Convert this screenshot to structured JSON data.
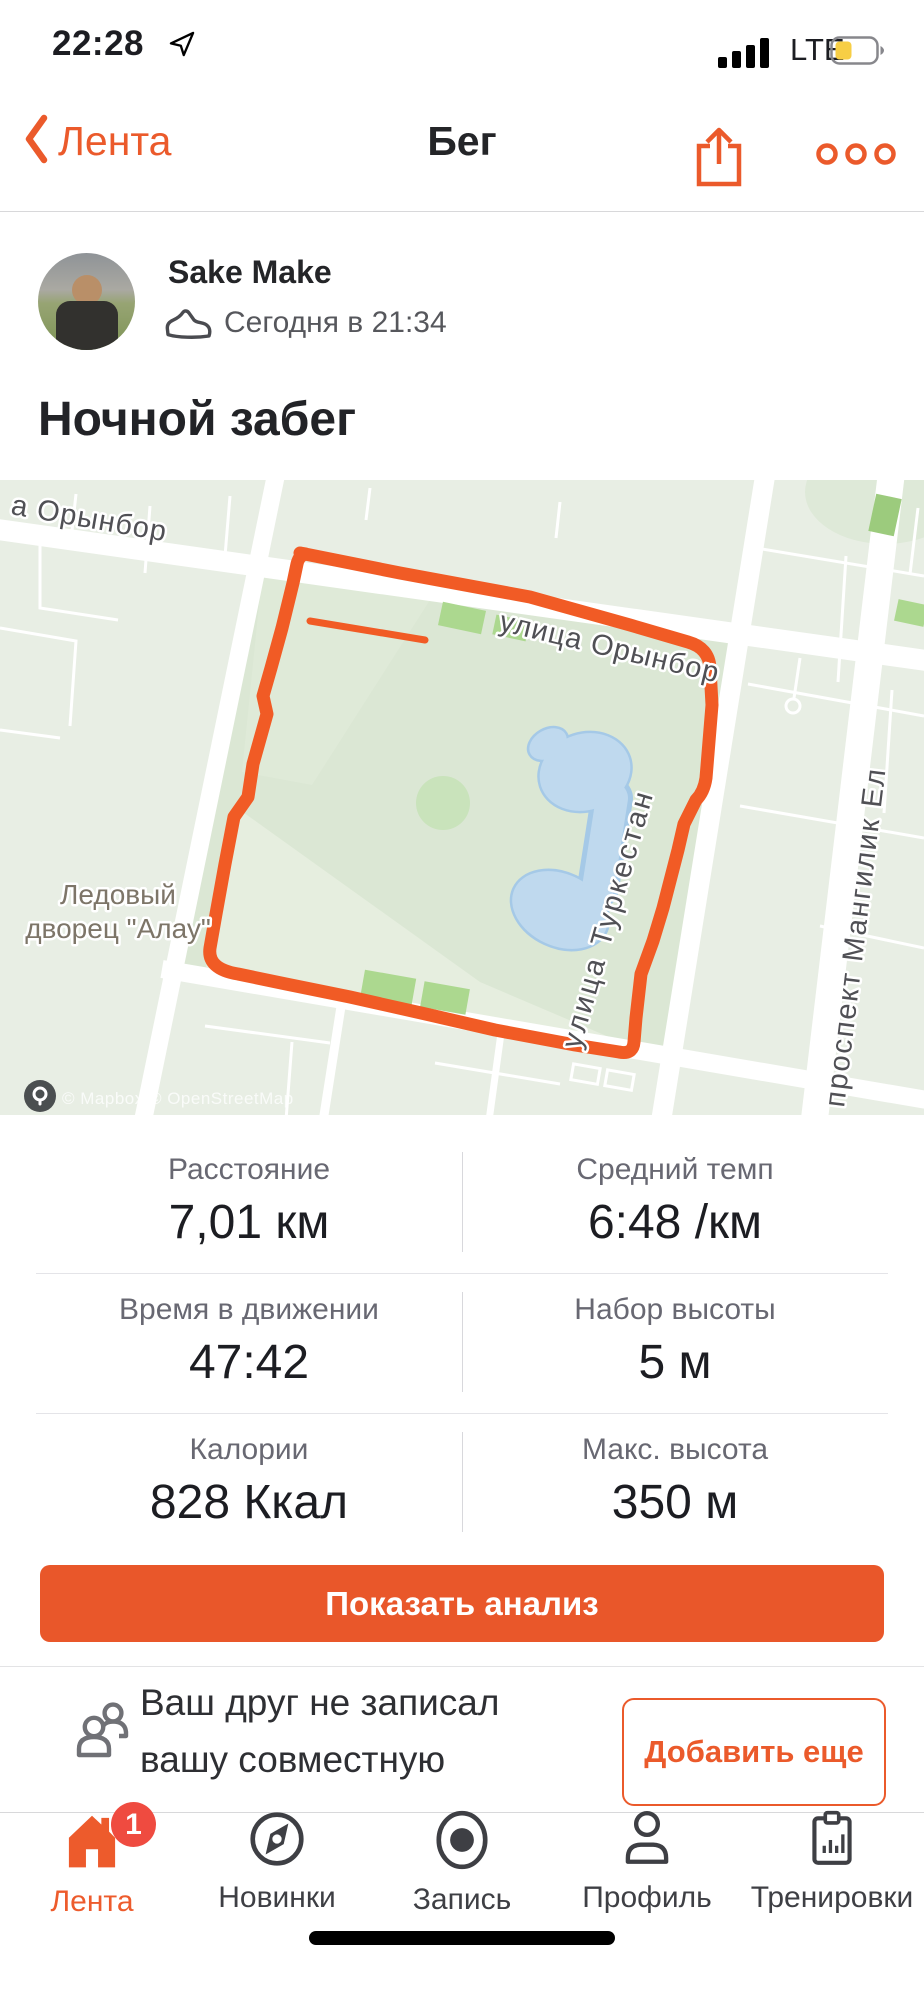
{
  "status_bar": {
    "time": "22:28",
    "network": "LTE"
  },
  "nav": {
    "back_label": "Лента",
    "title": "Бег"
  },
  "post": {
    "author": "Sake Make",
    "timestamp": "Сегодня в 21:34",
    "title": "Ночной забег"
  },
  "map": {
    "street_top_left": "а Орынбор",
    "street_orynbor": "улица Орынбор",
    "street_turkestan": "улица Туркестан",
    "street_mangilik": "проспект Мангилик Ел",
    "poi_line1": "Ледовый",
    "poi_line2": "дворец \"Алау\"",
    "attribution": "© Mapbox © OpenStreetMap",
    "route_color": "#F15B25"
  },
  "stats": [
    {
      "label": "Расстояние",
      "value": "7,01 км"
    },
    {
      "label": "Средний темп",
      "value": "6:48 /км"
    },
    {
      "label": "Время в движении",
      "value": "47:42"
    },
    {
      "label": "Набор высоты",
      "value": "5 м"
    },
    {
      "label": "Калории",
      "value": "828 Ккал"
    },
    {
      "label": "Макс. высота",
      "value": "350 м"
    }
  ],
  "analyze_button": {
    "label": "Показать анализ"
  },
  "friend_prompt": {
    "line1": "Ваш друг не записал",
    "line2": "вашу совместную",
    "action_label": "Добавить еще"
  },
  "tab_bar": {
    "items": [
      {
        "label": "Лента",
        "active": true,
        "badge": "1"
      },
      {
        "label": "Новинки",
        "active": false
      },
      {
        "label": "Запись",
        "active": false
      },
      {
        "label": "Профиль",
        "active": false
      },
      {
        "label": "Тренировки",
        "active": false
      }
    ]
  },
  "colors": {
    "accent": "#EB5A2B",
    "route": "#F15B25",
    "badge_red": "#EF4B40",
    "battery_low_power": "#F7CE45"
  }
}
